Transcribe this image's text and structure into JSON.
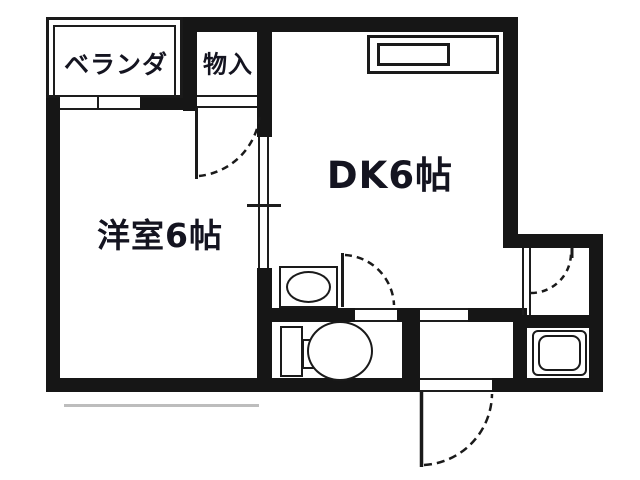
{
  "floorplan": {
    "type": "apartment-floor-plan",
    "colors": {
      "wall": "#161616",
      "background": "#ffffff",
      "line": "#1d1d1d"
    },
    "rooms": {
      "veranda": {
        "label": "ベランダ"
      },
      "closet": {
        "label": "物入"
      },
      "western_room": {
        "label": "洋室6帖"
      },
      "dining_kitchen": {
        "label": "DK6帖"
      }
    },
    "fixtures": {
      "kitchen_sink": "kitchen-counter-with-sink",
      "washbasin": "washbasin",
      "toilet": "toilet",
      "bathtub": "bathtub"
    },
    "doors": {
      "closet_door": "hinged-swing-into-western-room",
      "room_divider": "sliding-door",
      "washroom_door": "hinged-swing-into-dk",
      "bath_door": "hinged-swing",
      "entrance_door": "hinged-swing-outward"
    }
  }
}
